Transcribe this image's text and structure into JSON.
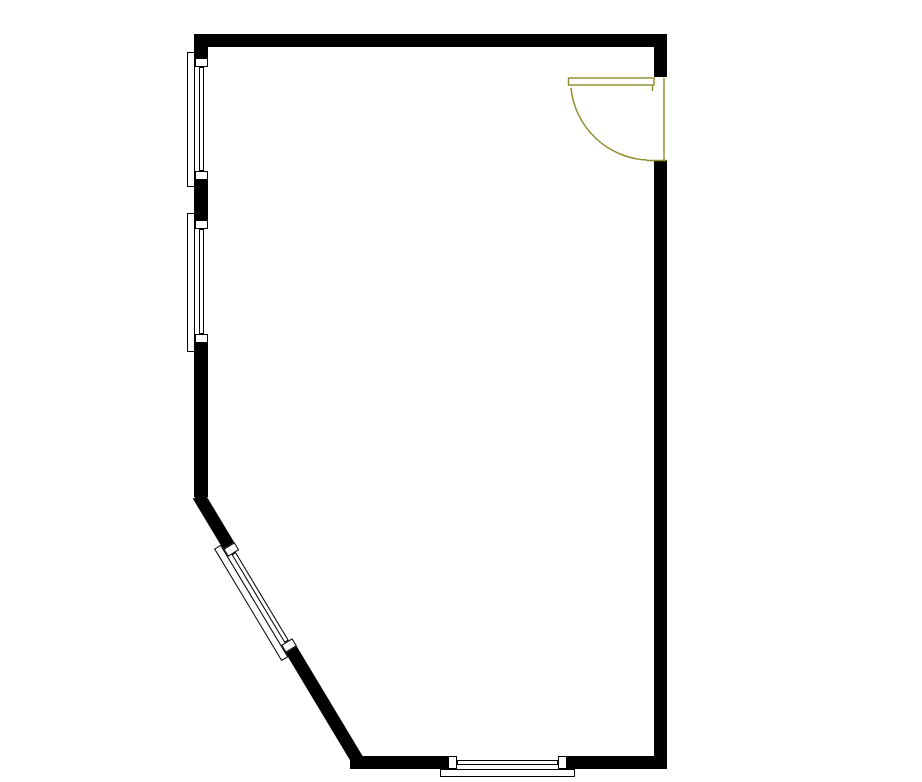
{
  "canvas": {
    "width": 922,
    "height": 782,
    "background": "#ffffff"
  },
  "palette": {
    "wall": "#000000",
    "window_stroke": "#000000",
    "window_fill": "#ffffff",
    "door": "#8b8b2b"
  },
  "floorplan": {
    "wall_thickness": 13,
    "walls": [
      {
        "id": "wall-top",
        "rect": [
          194,
          34,
          473,
          13
        ]
      },
      {
        "id": "wall-left",
        "rect": [
          194,
          34,
          13.5,
          463
        ]
      },
      {
        "id": "wall-right-above-door",
        "rect": [
          654,
          34,
          13,
          43
        ]
      },
      {
        "id": "wall-right",
        "rect": [
          654,
          160,
          13,
          609
        ]
      },
      {
        "id": "wall-bottom",
        "rect": [
          350,
          756,
          317,
          13
        ]
      },
      {
        "id": "wall-diagonal",
        "rect": [
          204.4,
          491.8,
          311,
          13
        ],
        "rotate": 59
      }
    ],
    "windows": [
      {
        "id": "window-left-upper",
        "anchor": [
          207.5,
          52
        ],
        "angle": 90,
        "length": 135,
        "sill_a": [
          6,
          15
        ],
        "sill_b": [
          119,
          128
        ]
      },
      {
        "id": "window-left-lower",
        "anchor": [
          207.5,
          213
        ],
        "angle": 90,
        "length": 139,
        "sill_a": [
          7,
          16
        ],
        "sill_b": [
          121,
          130
        ]
      },
      {
        "id": "window-diagonal",
        "anchor": [
          232.2,
          538.1
        ],
        "angle": 59,
        "length": 131,
        "sill_a": [
          5,
          14
        ],
        "sill_b": [
          117,
          126
        ]
      },
      {
        "id": "window-bottom",
        "anchor": [
          440,
          756
        ],
        "angle": 0,
        "length": 135,
        "sill_a": [
          8,
          17
        ],
        "sill_b": [
          118,
          127
        ]
      }
    ],
    "window_style": {
      "thickness": 13,
      "glass_offset": 4,
      "glass_depth": 5,
      "frame_depth": 8
    },
    "door": {
      "id": "door-top-right",
      "leaf": [
        568.5,
        78,
        85.5,
        7
      ],
      "hinge_tick": {
        "x1": 652.5,
        "y1": 85,
        "x2": 652.5,
        "y2": 91
      },
      "jamb_line": {
        "x1": 664,
        "y1": 77.5,
        "x2": 664,
        "y2": 160.5
      },
      "threshold_line": {
        "x1": 647,
        "y1": 160.5,
        "x2": 666.5,
        "y2": 160.5
      },
      "swing_arc": {
        "from": [
          571,
          88
        ],
        "to": [
          647,
          160
        ],
        "radius": 80
      },
      "stroke_width": 1.4
    }
  }
}
